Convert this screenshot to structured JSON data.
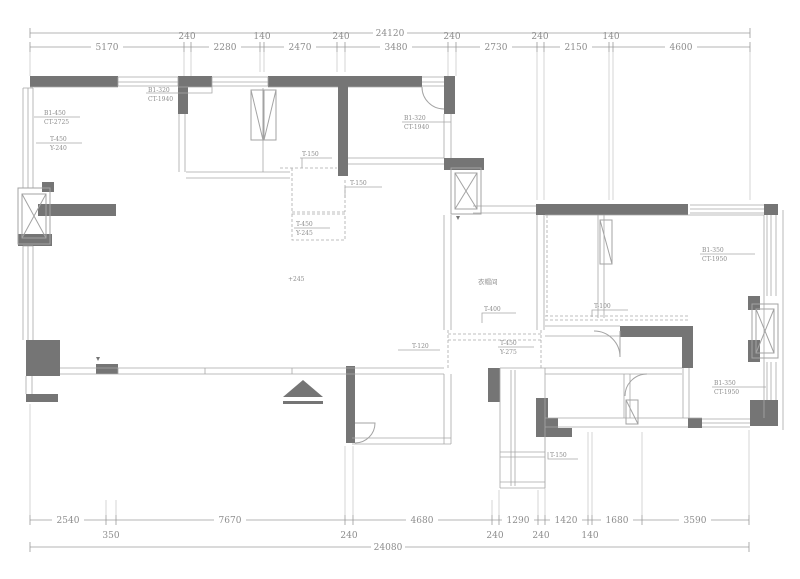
{
  "drawing": {
    "kind": "apartment floor plan (CAD)",
    "units": "mm"
  },
  "colors": {
    "wall": "#757575",
    "line": "#a3a3a3",
    "dimension_text": "#8d8d8d",
    "background": "#ffffff"
  },
  "dimensions": {
    "top": {
      "total": "24120",
      "segments": [
        "5170",
        "240",
        "2280",
        "140",
        "2470",
        "240",
        "3480",
        "240",
        "2730",
        "240",
        "2150",
        "140",
        "4600"
      ]
    },
    "bottom": {
      "total": "24080",
      "segments": [
        "2540",
        "350",
        "7670",
        "240",
        "4680",
        "240",
        "1290",
        "240",
        "1420",
        "140",
        "1680",
        "3590"
      ]
    }
  },
  "tags": [
    {
      "line1": "B1-320",
      "line2": "CT-1940"
    },
    {
      "line1": "B1-450",
      "line2": "CT-2725"
    },
    {
      "line1": "T-450",
      "line2": "Y-240"
    },
    {
      "line1": "B1-320",
      "line2": "CT-1940"
    },
    {
      "line1": "T-150"
    },
    {
      "line1": "T-150"
    },
    {
      "line1": "T-450",
      "line2": "Y-245"
    },
    {
      "line1": "+245"
    },
    {
      "line1": "衣帽间"
    },
    {
      "line1": "T-400"
    },
    {
      "line1": "T-100"
    },
    {
      "line1": "T-120"
    },
    {
      "line1": "T-450",
      "line2": "Y-275"
    },
    {
      "line1": "B1-350",
      "line2": "CT-1950"
    },
    {
      "line1": "B1-350",
      "line2": "CT-1950"
    },
    {
      "line1": "T-150"
    }
  ]
}
